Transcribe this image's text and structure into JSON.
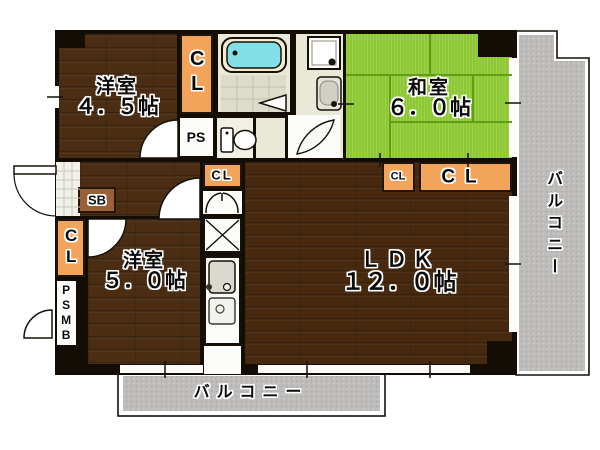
{
  "rooms": {
    "western_top": {
      "name": "洋室",
      "size": "４．５帖"
    },
    "japanese": {
      "name": "和室",
      "size": "６．０帖"
    },
    "western_bottom": {
      "name": "洋室",
      "size": "５．０帖"
    },
    "ldk": {
      "name": "ＬＤＫ",
      "size": "１２．０帖"
    }
  },
  "storage": {
    "cl_top": "CL",
    "ps": "PS",
    "sb": "SB",
    "cl_left": "CL",
    "psmb": "PSMB",
    "cl_hall": "CL",
    "cl_tatami_small": "CL",
    "cl_tatami_wide": "CL"
  },
  "balcony": {
    "right": "バルコニー",
    "bottom": "バルコニー"
  },
  "colors": {
    "wall": "#140d05",
    "wood": "#4a2d13",
    "wood_ldk": "#46290f",
    "tatami": "#8dc832",
    "tatami_line": "#5f9e14",
    "closet": "#f2a55a",
    "balcony": "#bdbcba",
    "bath_floor": "#eae8d6",
    "tile": "#dddbc9",
    "tub": "#82e0e6"
  }
}
